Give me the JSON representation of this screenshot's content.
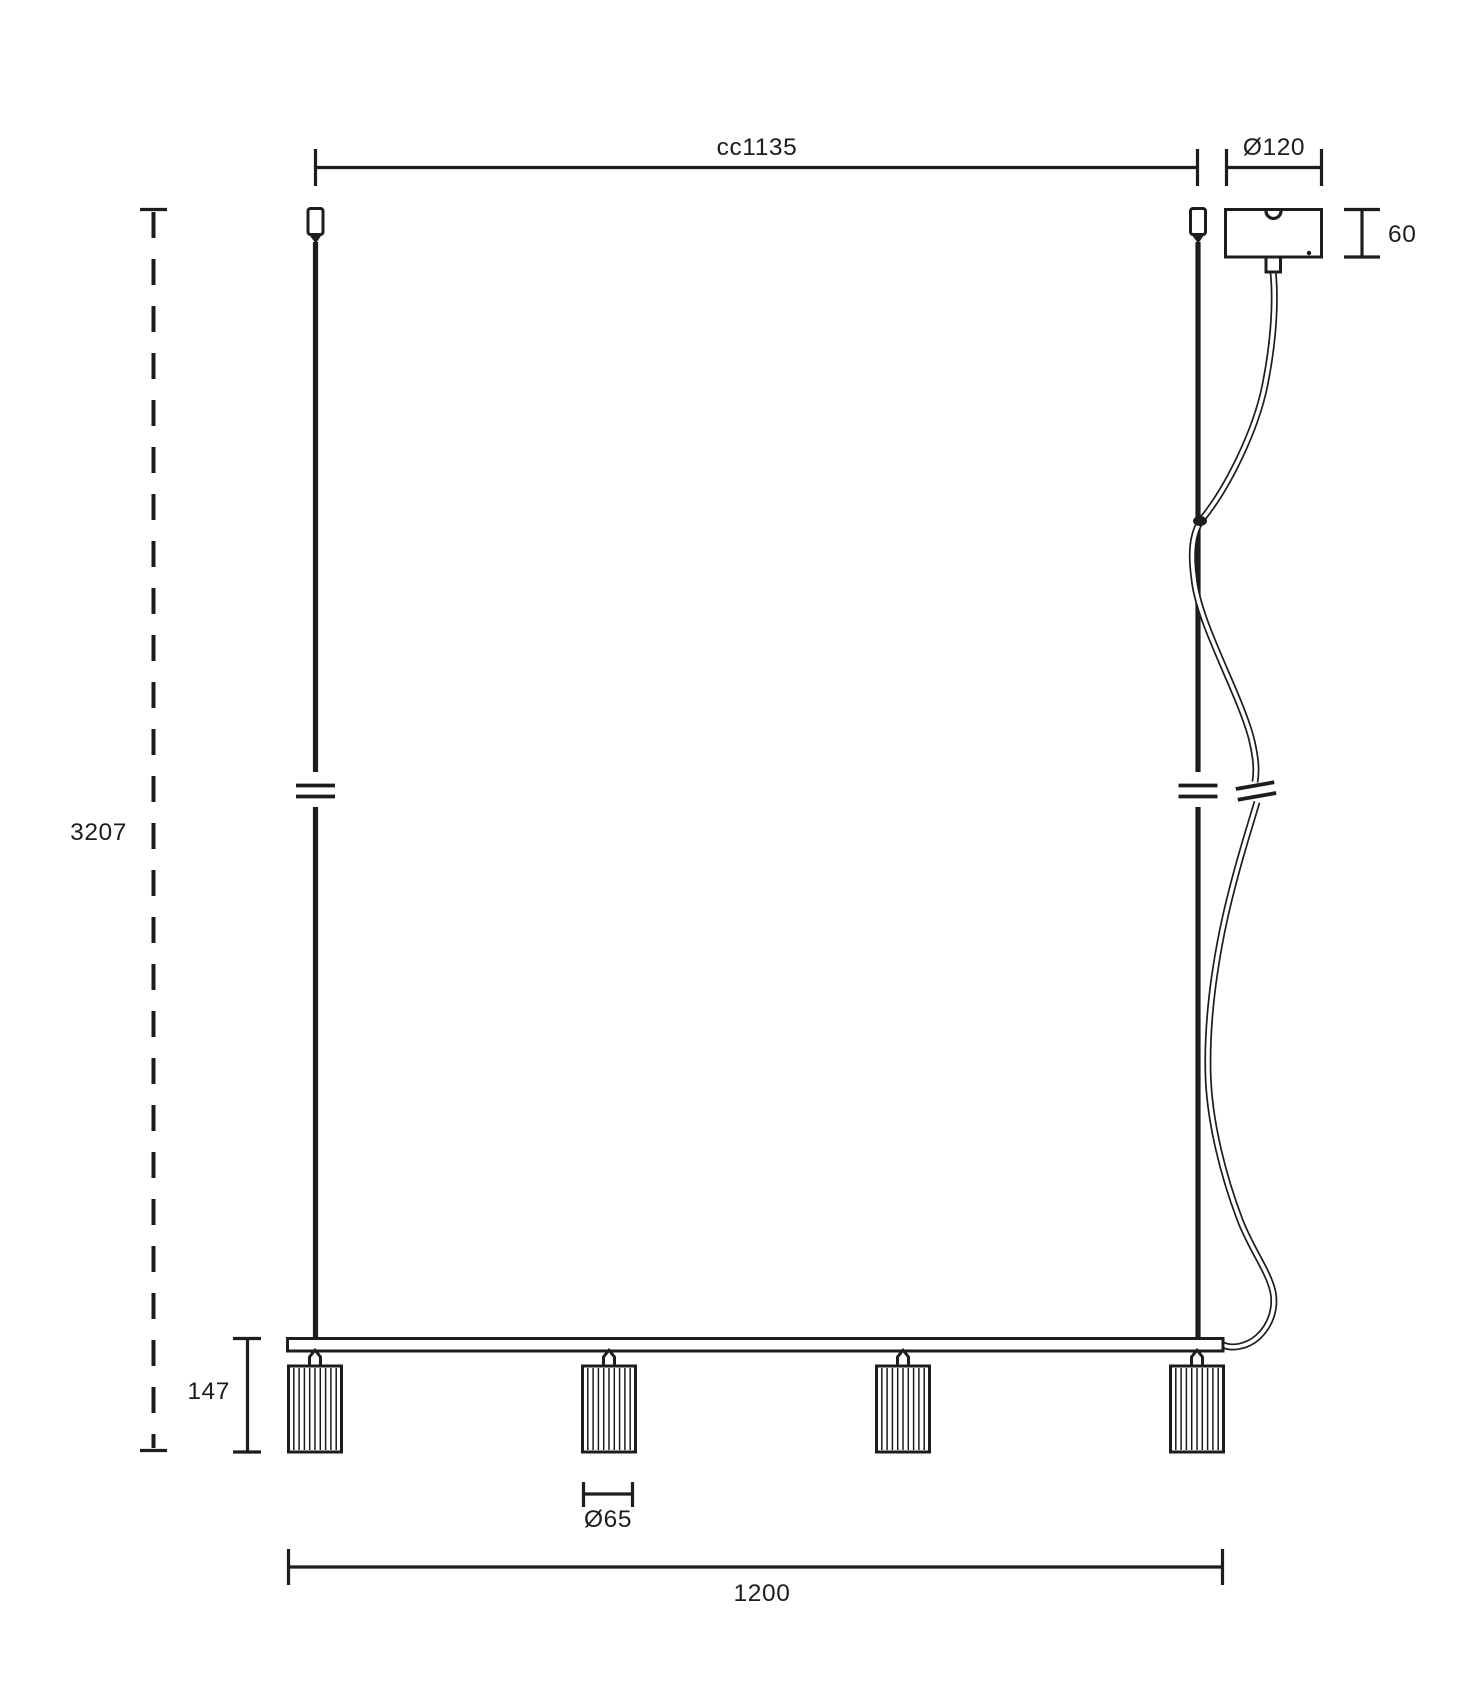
{
  "colors": {
    "ink": "#1d1d1b",
    "background": "#ffffff"
  },
  "labels": {
    "cc_distance": "cc1135",
    "canopy_diameter": "Ø120",
    "canopy_height": "60",
    "overall_height": "3207",
    "shade_drop": "147",
    "shade_diameter": "Ø65",
    "fixture_length": "1200"
  }
}
